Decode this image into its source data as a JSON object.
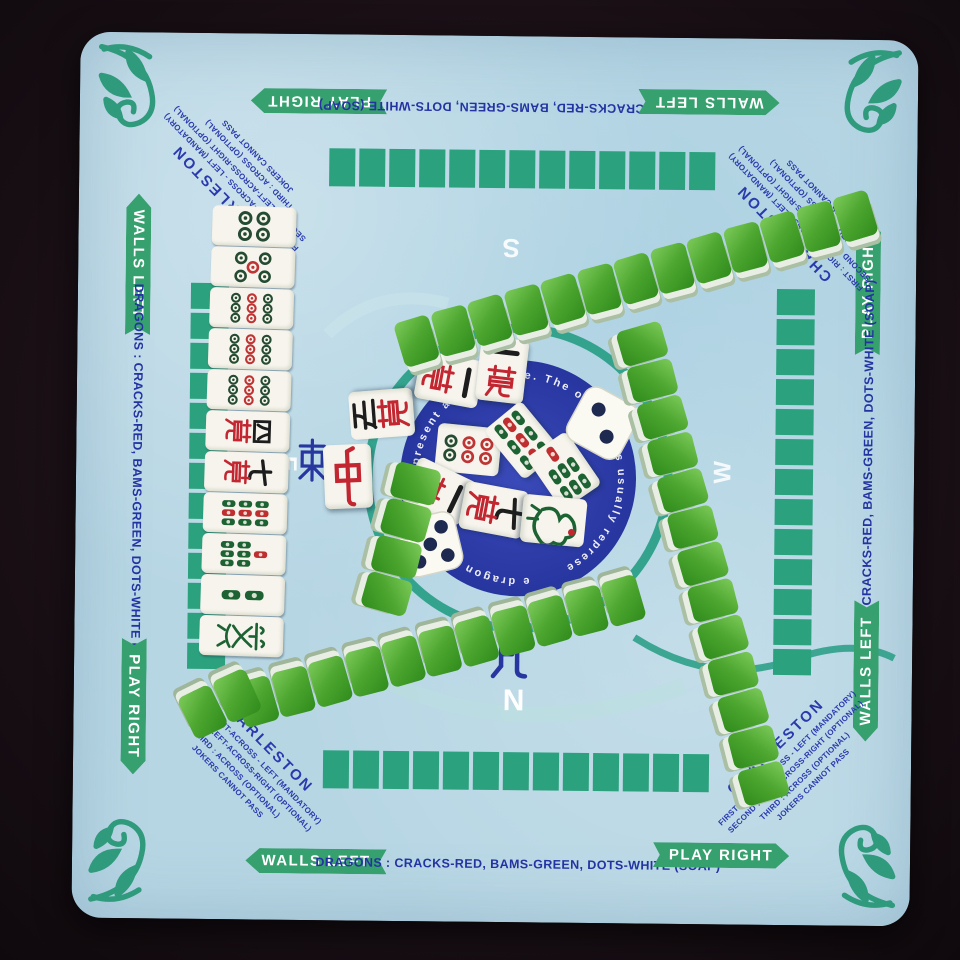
{
  "scene": {
    "description": "American mahjong set laid out on a light-blue table mat",
    "table_color": "#1a1016",
    "mat_color": "#b7d6e4"
  },
  "mat": {
    "labels": {
      "play_right": "PLAY RIGHT",
      "walls_left": "WALLS LEFT",
      "dragons": "DRAGONS : CRACKS-RED, BAMS-GREEN, DOTS-WHITE (SOAP)"
    },
    "charleston": {
      "title": "CHARLESTON",
      "lines": [
        "FIRST : RIGHT-ACROSS - LEFT (MANDATORY)",
        "SECOND : LEFT-ACROSS-RIGHT (OPTIONAL)",
        "THIRD : ACROSS (OPTIONAL)",
        "JOKERS CANNOT PASS"
      ]
    },
    "compass": {
      "north": "N",
      "south": "S",
      "east": "E",
      "west": "W",
      "north_char": "北",
      "east_char": "東"
    },
    "center_ring_fragments": [
      "present a ze",
      "game. The one-bam is usually represe",
      "e dragon is also us"
    ],
    "printed_squares_per_side": 13,
    "accent_teal": "#2ba17e",
    "text_blue": "#2433a2",
    "circle_color": "#2c3ba9",
    "ring_color": "#2ca089"
  },
  "pieces": {
    "left_column": [
      "4-dot",
      "5-dot",
      "9-dot",
      "9-dot",
      "9-dot",
      "4-crak",
      "7-crak",
      "9-bam",
      "7-bam",
      "2-bam",
      "green-dragon"
    ],
    "center_tiles": [
      "red-dragon",
      "5-crak",
      "1-crak",
      "1-crak",
      "6-dot",
      "9-bam",
      "7-bam",
      "1-crak",
      "7-crak",
      "1-bam"
    ],
    "walls": [
      {
        "name": "top",
        "tiles": 13
      },
      {
        "name": "right",
        "tiles": 13
      },
      {
        "name": "middle",
        "tiles": 11
      },
      {
        "name": "middle-start",
        "tiles": 2
      },
      {
        "name": "center-left",
        "tiles": 4
      }
    ],
    "dice": [
      {
        "pips": 2
      },
      {
        "pips": 5
      }
    ],
    "tile_back_color": "#4ca62f",
    "tile_face_color": "#f6f4ec",
    "suit_colors": {
      "crak_red": "#c22631",
      "bam_green": "#1d6233",
      "dot_green": "#264b33",
      "accent_red": "#bf3434"
    }
  }
}
